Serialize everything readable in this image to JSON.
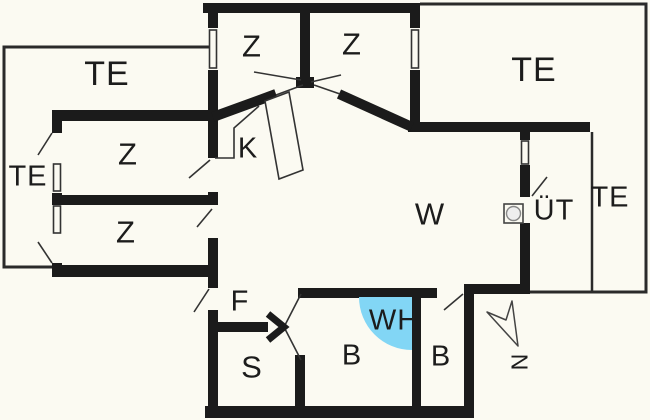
{
  "plan": {
    "colors": {
      "wall": "#1b1b1b",
      "background": "#fbfaf2",
      "water": "#82d6f5",
      "thin_line": "#333333"
    },
    "rooms": [
      {
        "id": "terrace-top-left",
        "label": "TE"
      },
      {
        "id": "bedroom-top-left",
        "label": "Z"
      },
      {
        "id": "bedroom-top-right",
        "label": "Z"
      },
      {
        "id": "terrace-top-right",
        "label": "TE"
      },
      {
        "id": "terrace-left",
        "label": "TE"
      },
      {
        "id": "bedroom-mid-left",
        "label": "Z"
      },
      {
        "id": "bedroom-lower-left",
        "label": "Z"
      },
      {
        "id": "kitchen",
        "label": "K"
      },
      {
        "id": "living-room",
        "label": "W"
      },
      {
        "id": "covered-terrace",
        "label": "ÜT"
      },
      {
        "id": "terrace-right",
        "label": "TE"
      },
      {
        "id": "hallway",
        "label": "F"
      },
      {
        "id": "whirlpool",
        "label": "WH"
      },
      {
        "id": "sauna",
        "label": "S"
      },
      {
        "id": "bathroom-left",
        "label": "B"
      },
      {
        "id": "bathroom-right",
        "label": "B"
      }
    ],
    "compass": {
      "label": "N"
    }
  }
}
